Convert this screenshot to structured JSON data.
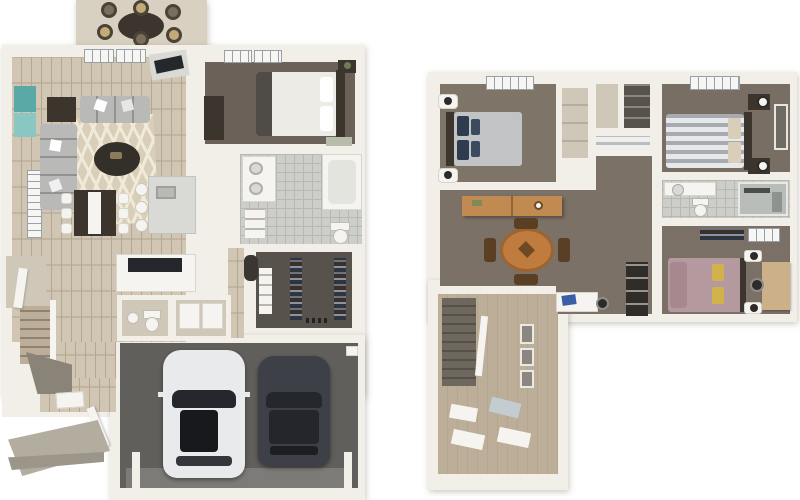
{
  "title": "two-story floor plan, 3d render, no text labels",
  "palette": {
    "bg": "#ffffff",
    "wall": "#f2efe8",
    "wall-shade": "#d9d4c8",
    "patio": "#d8d1c2",
    "porch": "#b3ada0",
    "wood": "#ccc0ab",
    "wood-line": "#b5a78f",
    "wood-stair": "#bcae99",
    "carpet": "#7b7166",
    "floor-bed1": "#6b6158",
    "floor-bed2": "#7e7468",
    "floor-bed3": "#786e63",
    "floor-bed4": "#7a7066",
    "closet-dark": "#57524b",
    "garage": "#615f5c",
    "garage-drive": "#7d7b77",
    "tile": "#cdcec9",
    "tile-line": "#b6b8b2",
    "sofa": "#a2a2a1",
    "sofa-light": "#c9c9c8",
    "rug": "#d9cfb9",
    "rug-pattern": "#f0ead9",
    "table-dark": "#3b352e",
    "wood-furn": "#c18a50",
    "wood-table": "#bf7c3e",
    "teal": "#5aa9a6",
    "teal-light": "#8ac6c2",
    "navy": "#2f3b4f",
    "bed-white": "#edebe6",
    "bed-gray": "#c2c3c5",
    "bed-mauve": "#b4999f",
    "pillow-mauve": "#a8888f",
    "pillow-yellow": "#d2b24c",
    "stripe-light": "#e6e8ea",
    "stripe-dark": "#a7abb1",
    "shelf-dark": "#2f2c29",
    "car-white": "#e9eaec",
    "car-dark": "#3d4046",
    "glass": "#24272c",
    "window": "#f6f7f5",
    "blind": "#9aa0a5",
    "frame": "#8b8680",
    "white-soft": "#f5f4f0",
    "sage": "#b7bda9",
    "tan-floor": "#cfc8b8",
    "steel": "#d9dad6"
  },
  "scene": {
    "floorplans": [
      {
        "id": "first-floor",
        "rooms": [
          "patio",
          "living-room",
          "dining-area",
          "kitchen",
          "bedroom",
          "bathroom",
          "walk-in-closet",
          "utility-closet",
          "laundry",
          "powder-room",
          "coat-closet",
          "stairs",
          "entry",
          "front-porch",
          "two-car-garage"
        ],
        "vehicles": [
          "white-car",
          "dark-car"
        ]
      },
      {
        "id": "second-floor",
        "rooms": [
          "bedroom-left",
          "hall-closets",
          "bedroom-right",
          "bathroom",
          "bedroom-bottom",
          "loft",
          "hallway",
          "stairwell"
        ]
      }
    ]
  }
}
